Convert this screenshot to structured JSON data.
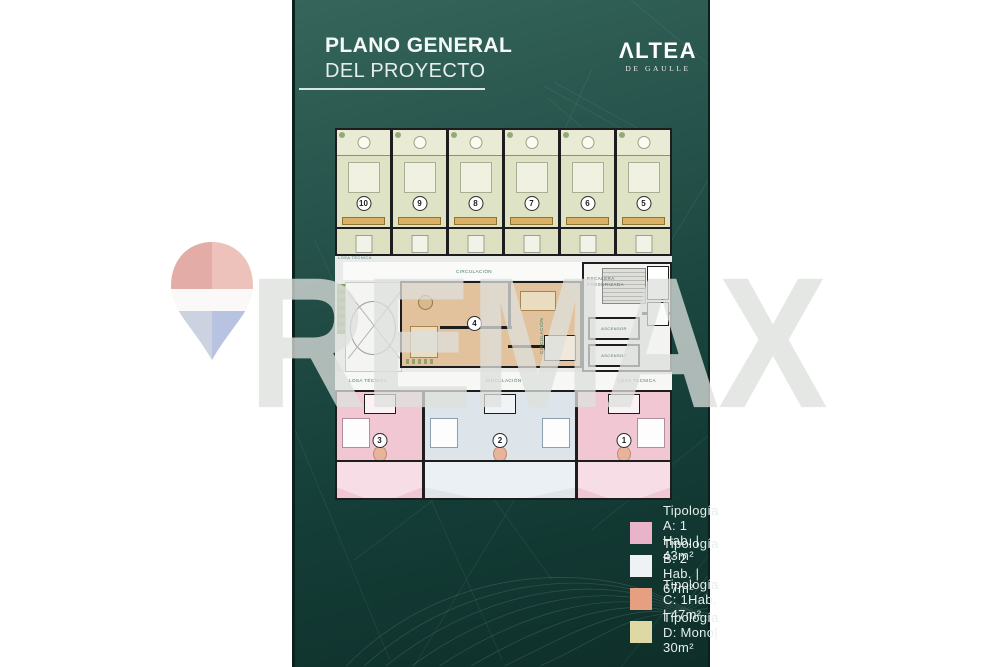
{
  "header": {
    "title_line1": "PLANO GENERAL",
    "title_line2": "DEL PROYECTO"
  },
  "brand": {
    "name": "ΛLTEA",
    "subtitle": "DE GAULLE"
  },
  "watermark": {
    "text": "REMAX"
  },
  "floorplan": {
    "labels": {
      "circulation": "CIRCULACIÓN",
      "technical_slab": "LOSA TÉCNICA",
      "pressurized_stair": "ESCALERA PRESURIZADA",
      "elevator": "ASCENSOR"
    },
    "units_top": [
      {
        "number": "10",
        "type": "D"
      },
      {
        "number": "9",
        "type": "D"
      },
      {
        "number": "8",
        "type": "D"
      },
      {
        "number": "7",
        "type": "D"
      },
      {
        "number": "6",
        "type": "D"
      },
      {
        "number": "5",
        "type": "D"
      }
    ],
    "unit_middle": {
      "number": "4",
      "type": "C"
    },
    "units_bottom": [
      {
        "number": "3",
        "type": "A"
      },
      {
        "number": "2",
        "type": "B"
      },
      {
        "number": "1",
        "type": "A"
      }
    ]
  },
  "legend": {
    "items": [
      {
        "label": "Tipología A: 1 Hab. | 43m²",
        "color": "#e9b4c9"
      },
      {
        "label": "Tipología B: 2 Hab. | 67m²",
        "color": "#eef2f4"
      },
      {
        "label": "Tipología C: 1Hab. | 47m²",
        "color": "#e79f82"
      },
      {
        "label": "Tipología D: Mono| 30m²",
        "color": "#ddd8a4"
      }
    ]
  },
  "colors": {
    "panel_top": "#35655b",
    "panel_bottom": "#0e2e29",
    "wall": "#1d1d1d",
    "type_a_fill": "#f1c7d3",
    "type_b_fill": "#dde4ea",
    "type_c_fill": "#e2c29c",
    "type_d_fill": "#dfe3c6"
  }
}
